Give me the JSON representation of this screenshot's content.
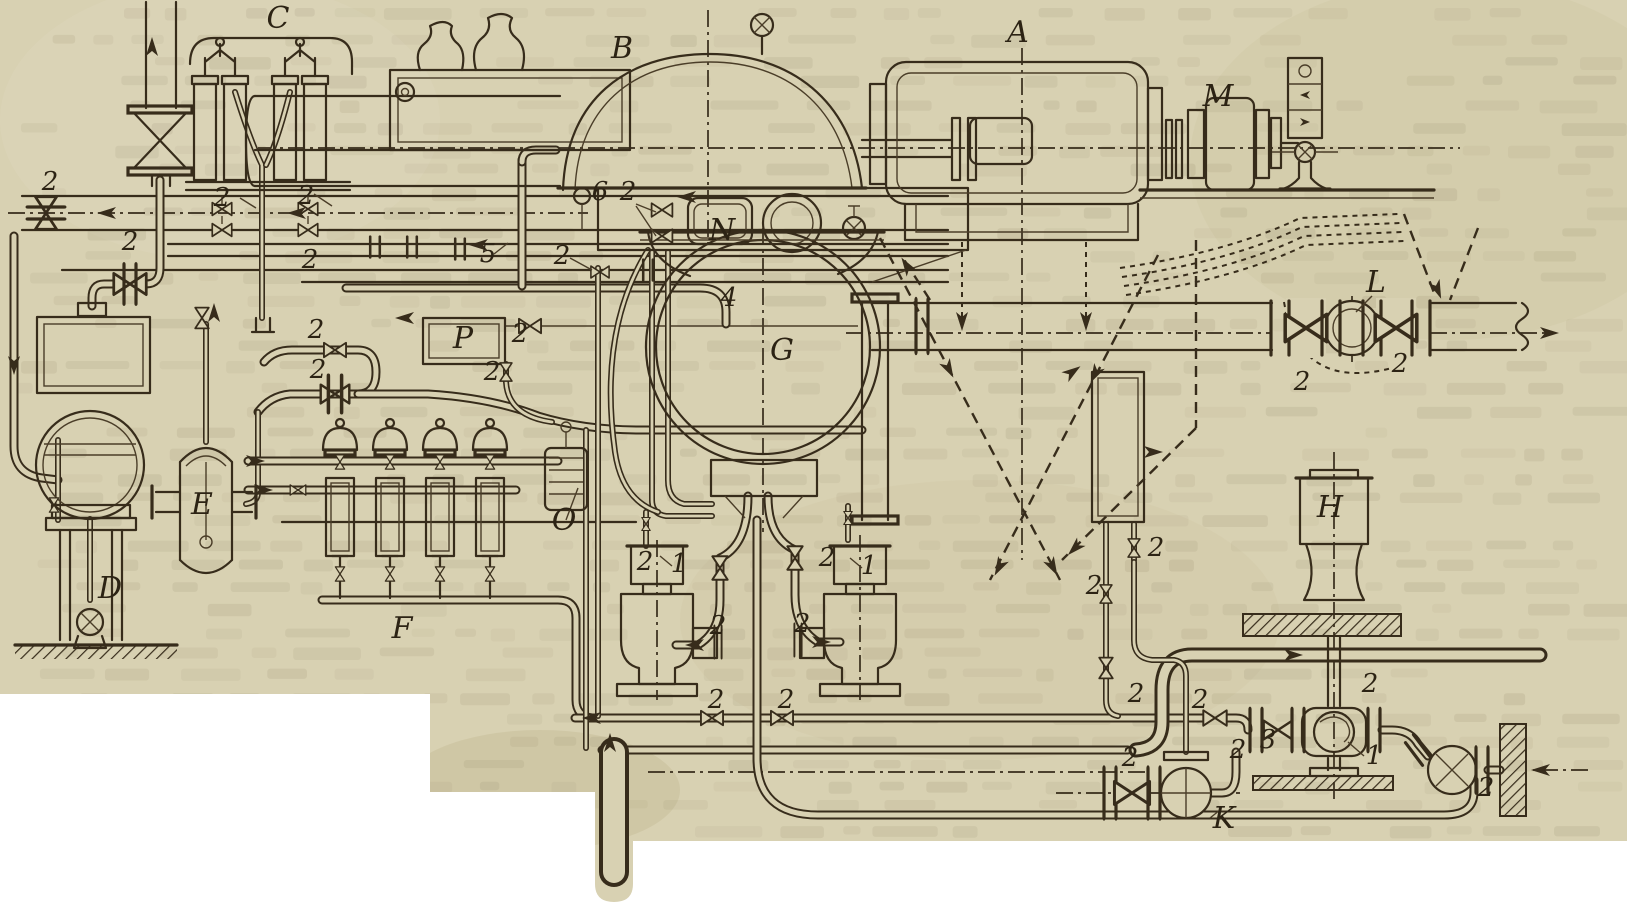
{
  "diagram": {
    "kind": "scanned technical piping diagram of a steam turbine set",
    "letter_labels": [
      {
        "text": "A",
        "x": 1018,
        "y": 42
      },
      {
        "text": "B",
        "x": 622,
        "y": 58
      },
      {
        "text": "C",
        "x": 278,
        "y": 28
      },
      {
        "text": "D",
        "x": 110,
        "y": 598
      },
      {
        "text": "E",
        "x": 202,
        "y": 514
      },
      {
        "text": "F",
        "x": 402,
        "y": 638
      },
      {
        "text": "G",
        "x": 782,
        "y": 360
      },
      {
        "text": "H",
        "x": 1330,
        "y": 517
      },
      {
        "text": "K",
        "x": 1224,
        "y": 828
      },
      {
        "text": "L",
        "x": 1376,
        "y": 292
      },
      {
        "text": "M",
        "x": 1218,
        "y": 106
      },
      {
        "text": "N",
        "x": 722,
        "y": 240
      },
      {
        "text": "O",
        "x": 564,
        "y": 530
      },
      {
        "text": "P",
        "x": 463,
        "y": 348
      }
    ],
    "number_labels": [
      {
        "text": "2",
        "x": 50,
        "y": 190
      },
      {
        "text": "2",
        "x": 130,
        "y": 250
      },
      {
        "text": "2",
        "x": 222,
        "y": 206
      },
      {
        "text": "2",
        "x": 306,
        "y": 204
      },
      {
        "text": "2",
        "x": 310,
        "y": 268
      },
      {
        "text": "2",
        "x": 316,
        "y": 338
      },
      {
        "text": "2",
        "x": 318,
        "y": 378
      },
      {
        "text": "2",
        "x": 562,
        "y": 264
      },
      {
        "text": "2",
        "x": 628,
        "y": 200
      },
      {
        "text": "2",
        "x": 520,
        "y": 342
      },
      {
        "text": "2",
        "x": 492,
        "y": 380
      },
      {
        "text": "2",
        "x": 645,
        "y": 570
      },
      {
        "text": "2",
        "x": 827,
        "y": 566
      },
      {
        "text": "2",
        "x": 718,
        "y": 634
      },
      {
        "text": "2",
        "x": 802,
        "y": 632
      },
      {
        "text": "2",
        "x": 716,
        "y": 708
      },
      {
        "text": "2",
        "x": 786,
        "y": 708
      },
      {
        "text": "2",
        "x": 1200,
        "y": 708
      },
      {
        "text": "2",
        "x": 1156,
        "y": 556
      },
      {
        "text": "2",
        "x": 1094,
        "y": 594
      },
      {
        "text": "2",
        "x": 1136,
        "y": 702
      },
      {
        "text": "2",
        "x": 1302,
        "y": 390
      },
      {
        "text": "2",
        "x": 1400,
        "y": 372
      },
      {
        "text": "2",
        "x": 1370,
        "y": 692
      },
      {
        "text": "2",
        "x": 1238,
        "y": 758
      },
      {
        "text": "2",
        "x": 1486,
        "y": 796
      },
      {
        "text": "2",
        "x": 1130,
        "y": 766
      },
      {
        "text": "1",
        "x": 679,
        "y": 572
      },
      {
        "text": "1",
        "x": 869,
        "y": 574
      },
      {
        "text": "1",
        "x": 1374,
        "y": 764
      },
      {
        "text": "3",
        "x": 1268,
        "y": 748
      },
      {
        "text": "4",
        "x": 729,
        "y": 306
      },
      {
        "text": "5",
        "x": 488,
        "y": 262
      },
      {
        "text": "6",
        "x": 600,
        "y": 200
      }
    ]
  },
  "colors": {
    "paper": "#d8d1b2",
    "ink": "#372c1b",
    "page_background": "#ffffff",
    "bleedthrough": "#7a6d4e"
  }
}
